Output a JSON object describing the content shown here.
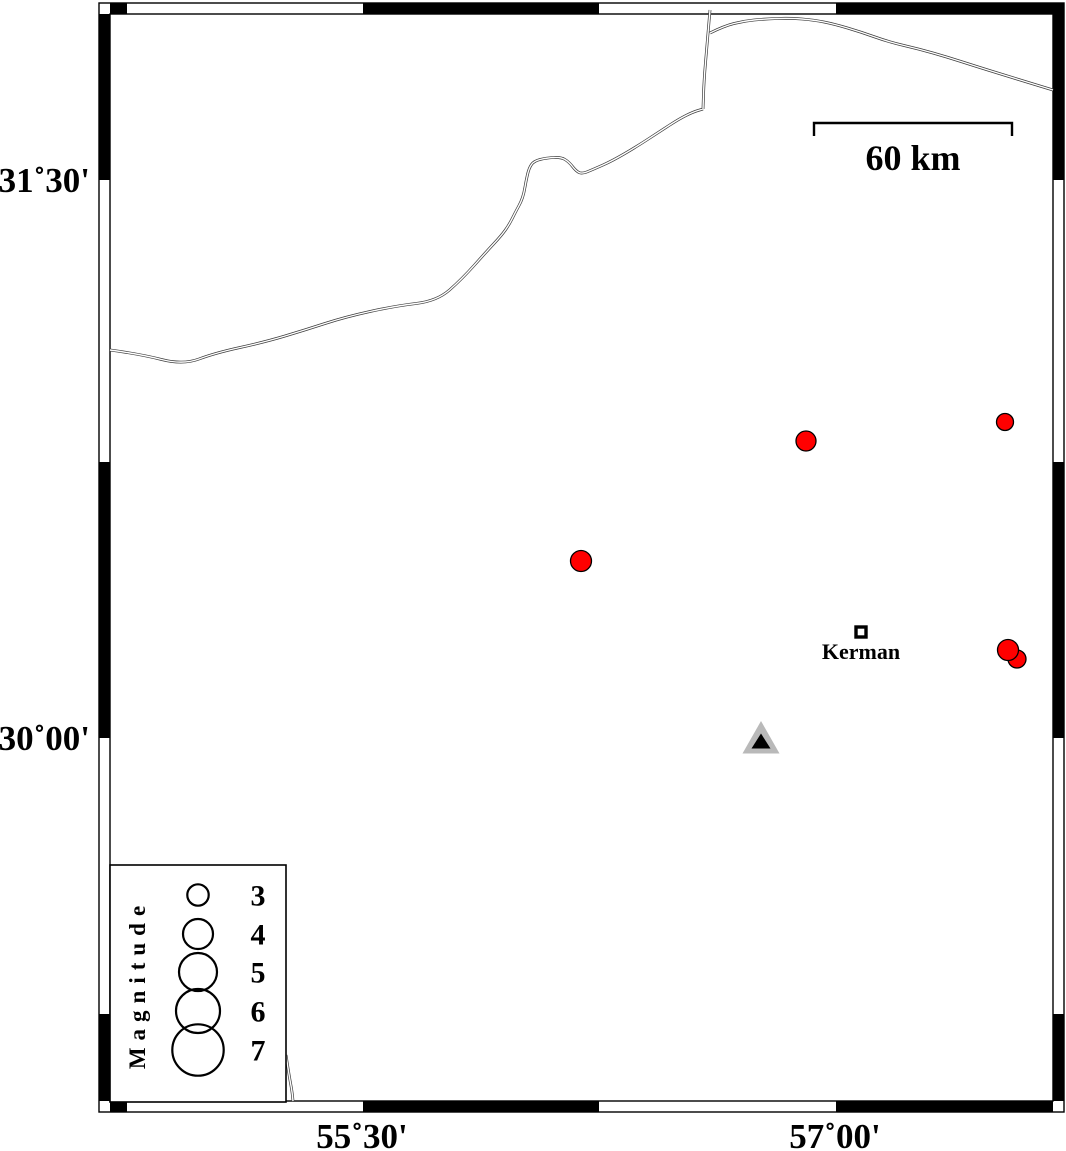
{
  "map": {
    "axis": {
      "left": [
        {
          "text": "31˚30'"
        },
        {
          "text": "30˚00'"
        }
      ],
      "bottom": [
        {
          "text": "55˚30'"
        },
        {
          "text": "57˚00'"
        }
      ]
    },
    "scalebar": {
      "label": "60 km",
      "x1": 814,
      "x2": 1012,
      "y": 123,
      "tick_drop": 13
    },
    "city": {
      "label": "Kerman",
      "square": {
        "x": 856,
        "y": 627,
        "size": 10,
        "stroke": 3.4
      }
    },
    "frame": {
      "outer": {
        "x": 99,
        "y": 3,
        "w": 965,
        "h": 1109
      },
      "inner": {
        "x": 110,
        "y": 14,
        "w": 943,
        "h": 1087
      },
      "band": 11,
      "top_black": [
        [
          110,
          127
        ],
        [
          363,
          599
        ],
        [
          836,
          1064
        ]
      ],
      "bottom_black": [
        [
          110,
          127
        ],
        [
          363,
          599
        ],
        [
          836,
          1053
        ]
      ],
      "left_black": [
        [
          14,
          180
        ],
        [
          462,
          738
        ],
        [
          1014,
          1101
        ]
      ],
      "right_black": [
        [
          14,
          180
        ],
        [
          462,
          738
        ],
        [
          1014,
          1101
        ]
      ]
    },
    "epicenters": [
      {
        "x": 806,
        "y": 441,
        "r": 10
      },
      {
        "x": 1005,
        "y": 422,
        "r": 8.5
      },
      {
        "x": 581,
        "y": 561,
        "r": 10.5
      },
      {
        "x": 1017,
        "y": 659,
        "r": 9
      },
      {
        "x": 1008,
        "y": 650,
        "r": 10.5
      }
    ],
    "station": {
      "outer": [
        [
          761,
          721
        ],
        [
          742.5,
          753.5
        ],
        [
          779.5,
          753.5
        ]
      ],
      "inner": [
        [
          761,
          733.5
        ],
        [
          751.5,
          748.5
        ],
        [
          770.5,
          748.5
        ]
      ]
    },
    "legend": {
      "title": "Magnitude",
      "box": {
        "x": 110,
        "y": 865,
        "w": 176,
        "h": 237
      },
      "circle_cx": 198,
      "num_x": 258,
      "entries": [
        {
          "label": "3",
          "cy": 895,
          "r": 10.7
        },
        {
          "label": "4",
          "cy": 934,
          "r": 15
        },
        {
          "label": "5",
          "cy": 972,
          "r": 19
        },
        {
          "label": "6",
          "cy": 1011,
          "r": 22
        },
        {
          "label": "7",
          "cy": 1050,
          "r": 25.7
        }
      ]
    },
    "roads": [
      [
        [
          110,
          350
        ],
        [
          140,
          354
        ],
        [
          183,
          365
        ],
        [
          215,
          353
        ],
        [
          265,
          342
        ],
        [
          305,
          330
        ],
        [
          345,
          317
        ],
        [
          395,
          306
        ],
        [
          437,
          301
        ],
        [
          462,
          279
        ],
        [
          487,
          251
        ],
        [
          501,
          236
        ],
        [
          509,
          225
        ],
        [
          516,
          211
        ],
        [
          521,
          202
        ],
        [
          524,
          193
        ],
        [
          526,
          181
        ],
        [
          529,
          168
        ],
        [
          534,
          161
        ],
        [
          546,
          158
        ],
        [
          561,
          157
        ],
        [
          569,
          162
        ],
        [
          576,
          171
        ],
        [
          582,
          174
        ],
        [
          594,
          169
        ],
        [
          612,
          161
        ],
        [
          636,
          147
        ],
        [
          659,
          132
        ],
        [
          679,
          119
        ],
        [
          693,
          112
        ],
        [
          703,
          109
        ]
      ],
      [
        [
          710,
          10
        ],
        [
          707,
          45
        ],
        [
          704,
          80
        ],
        [
          703,
          109
        ]
      ],
      [
        [
          710,
          33
        ],
        [
          724,
          26
        ],
        [
          744,
          21
        ],
        [
          764,
          19
        ],
        [
          790,
          18
        ],
        [
          814,
          20
        ],
        [
          834,
          24
        ],
        [
          861,
          32
        ],
        [
          889,
          42
        ],
        [
          919,
          49
        ],
        [
          947,
          57
        ],
        [
          975,
          66
        ],
        [
          1004,
          75
        ],
        [
          1030,
          83
        ],
        [
          1053,
          90
        ]
      ],
      [
        [
          286,
          1055
        ],
        [
          289,
          1075
        ],
        [
          292,
          1091
        ],
        [
          293,
          1101
        ]
      ]
    ],
    "colors": {
      "epicenter_fill": "#ff0000",
      "epicenter_stroke": "#000000",
      "station_fill": "#b9b9b9",
      "station_inner": "#000000",
      "road": "#3c3c3c",
      "frame": "#000000"
    }
  }
}
